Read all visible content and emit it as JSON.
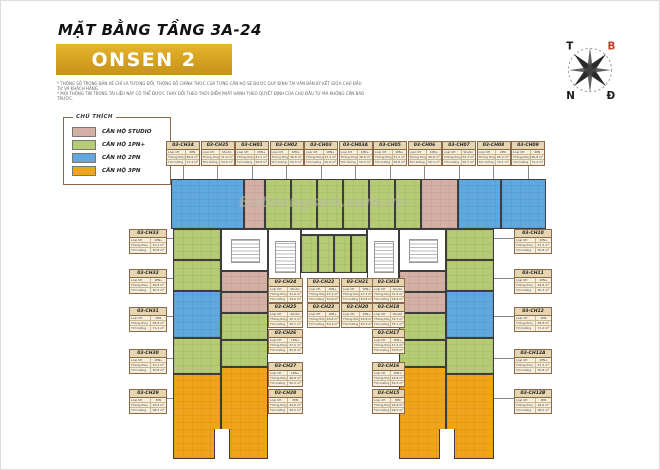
{
  "header": {
    "floor_title": "MẶT BẰNG TẦNG 3A-24",
    "building_name": "ONSEN 2",
    "disclaimers": [
      "* THÔNG SỐ TRONG BẢN VẼ CHỈ LÀ TƯƠNG ĐỐI, THÔNG SỐ CHÍNH THỨC CỦA TỪNG CĂN HỘ SẼ ĐƯỢC QUY ĐỊNH TẠI VĂN BẢN KÝ KẾT GIỮA CHỦ ĐẦU TƯ VÀ KHÁCH HÀNG.",
      "* MỌI THÔNG TIN TRONG TÀI LIỆU NÀY CÓ THỂ ĐƯỢC THAY ĐỔI THEO THỜI ĐIỂM PHÁT HÀNH THEO QUYẾT ĐỊNH CỦA CHỦ ĐẦU TƯ MÀ KHÔNG CẦN BÁO TRƯỚC."
    ]
  },
  "legend": {
    "title": "CHÚ THÍCH",
    "items": [
      {
        "type": "Studio",
        "label": "CĂN HỘ STUDIO",
        "color": "#d4b0a4"
      },
      {
        "type": "1PN+",
        "label": "CĂN HỘ 1PN+",
        "color": "#b5cb74"
      },
      {
        "type": "2PN",
        "label": "CĂN HỘ 2PN",
        "color": "#5fa9e0"
      },
      {
        "type": "3PN",
        "label": "CĂN HỘ 3PN",
        "color": "#f0a41c"
      }
    ]
  },
  "compass": {
    "west": "T",
    "north": "B",
    "south": "N",
    "east": "Đ"
  },
  "watermark": "Batdongsan.com.vn",
  "unit_table": {
    "row_keys": [
      "Loại CH",
      "Thông thủy",
      "Tim tường"
    ]
  },
  "units": {
    "top_row": [
      {
        "id": "03-CH34",
        "type": "2PN",
        "net": "66.8 m²",
        "gross": "71.4 m²"
      },
      {
        "id": "03-CH35",
        "type": "Studio",
        "net": "31.9 m²",
        "gross": "34.6 m²"
      },
      {
        "id": "03-CH01",
        "type": "1PN+",
        "net": "47.2 m²",
        "gross": "50.8 m²"
      },
      {
        "id": "03-CH02",
        "type": "1PN+",
        "net": "46.8 m²",
        "gross": "50.3 m²"
      },
      {
        "id": "03-CH03",
        "type": "1PN+",
        "net": "47.2 m²",
        "gross": "50.8 m²"
      },
      {
        "id": "03-CH03A",
        "type": "1PN+",
        "net": "46.8 m²",
        "gross": "50.3 m²"
      },
      {
        "id": "03-CH05",
        "type": "1PN+",
        "net": "47.2 m²",
        "gross": "50.8 m²"
      },
      {
        "id": "03-CH06",
        "type": "1PN+",
        "net": "46.8 m²",
        "gross": "50.3 m²"
      },
      {
        "id": "03-CH07",
        "type": "Studio",
        "net": "32.3 m²",
        "gross": "35.1 m²"
      },
      {
        "id": "03-CH08",
        "type": "2PN",
        "net": "65.4 m²",
        "gross": "70.1 m²"
      },
      {
        "id": "03-CH09",
        "type": "2PN",
        "net": "66.8 m²",
        "gross": "71.4 m²"
      }
    ],
    "left_outer": [
      {
        "id": "03-CH33",
        "type": "1PN+",
        "net": "47.2 m²",
        "gross": "50.8 m²"
      },
      {
        "id": "03-CH32",
        "type": "1PN+",
        "net": "46.8 m²",
        "gross": "50.3 m²"
      },
      {
        "id": "03-CH31",
        "type": "2PN",
        "net": "66.8 m²",
        "gross": "71.4 m²"
      },
      {
        "id": "03-CH30",
        "type": "1PN+",
        "net": "47.2 m²",
        "gross": "50.8 m²"
      },
      {
        "id": "03-CH29",
        "type": "3PN",
        "net": "93.6 m²",
        "gross": "98.2 m²"
      }
    ],
    "inner_a": [
      {
        "id": "03-CH24",
        "type": "Studio",
        "net": "31.9 m²",
        "gross": "34.6 m²"
      },
      {
        "id": "03-CH25",
        "type": "Studio",
        "net": "32.3 m²",
        "gross": "35.1 m²"
      },
      {
        "id": "03-CH26",
        "type": "1PN+",
        "net": "47.2 m²",
        "gross": "50.8 m²"
      },
      {
        "id": "03-CH27",
        "type": "1PN+",
        "net": "46.8 m²",
        "gross": "50.3 m²"
      },
      {
        "id": "03-CH28",
        "type": "3PN",
        "net": "94.8 m²",
        "gross": "99.5 m²"
      }
    ],
    "inner_b": [
      {
        "id": "03-CH22",
        "type": "1PN+",
        "net": "47.2 m²",
        "gross": "50.8 m²"
      },
      {
        "id": "03-CH23",
        "type": "1PN+",
        "net": "46.8 m²",
        "gross": "50.3 m²"
      }
    ],
    "inner_c": [
      {
        "id": "03-CH21",
        "type": "1PN+",
        "net": "47.2 m²",
        "gross": "50.8 m²"
      },
      {
        "id": "03-CH20",
        "type": "1PN+",
        "net": "46.8 m²",
        "gross": "50.3 m²"
      }
    ],
    "inner_d": [
      {
        "id": "03-CH19",
        "type": "Studio",
        "net": "31.9 m²",
        "gross": "34.6 m²"
      },
      {
        "id": "03-CH18",
        "type": "Studio",
        "net": "32.3 m²",
        "gross": "35.1 m²"
      },
      {
        "id": "03-CH17",
        "type": "1PN+",
        "net": "47.2 m²",
        "gross": "50.8 m²"
      },
      {
        "id": "03-CH16",
        "type": "1PN+",
        "net": "46.8 m²",
        "gross": "50.3 m²"
      },
      {
        "id": "03-CH15",
        "type": "3PN",
        "net": "94.8 m²",
        "gross": "99.5 m²"
      }
    ],
    "right_outer": [
      {
        "id": "03-CH10",
        "type": "1PN+",
        "net": "47.2 m²",
        "gross": "50.8 m²"
      },
      {
        "id": "03-CH11",
        "type": "1PN+",
        "net": "46.8 m²",
        "gross": "50.3 m²"
      },
      {
        "id": "03-CH12",
        "type": "2PN",
        "net": "66.8 m²",
        "gross": "71.4 m²"
      },
      {
        "id": "03-CH12A",
        "type": "1PN+",
        "net": "47.2 m²",
        "gross": "50.8 m²"
      },
      {
        "id": "03-CH12B",
        "type": "3PN",
        "net": "93.6 m²",
        "gross": "98.2 m²"
      }
    ]
  }
}
